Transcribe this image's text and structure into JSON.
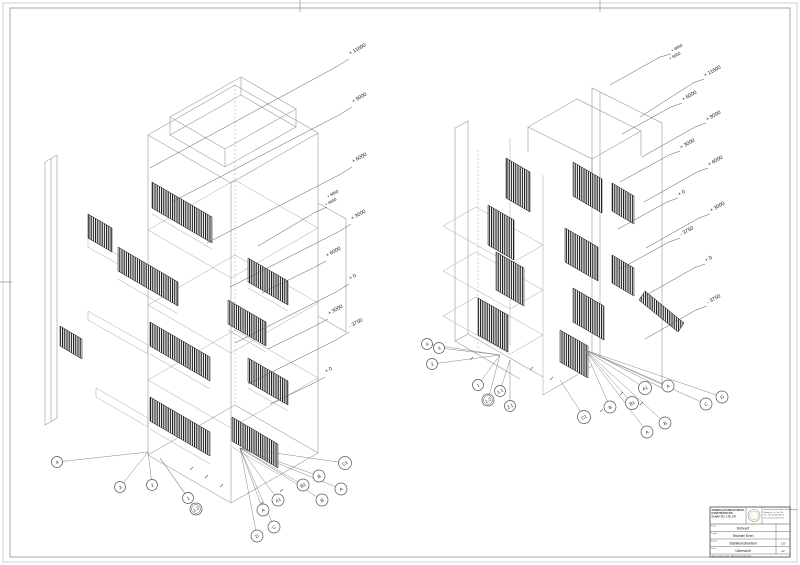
{
  "views": {
    "left": {
      "elevations": [
        "+ 11600",
        "+ 9000",
        "+ 6000",
        "+ 8850",
        "+ 8650",
        "+ 3000",
        "+ 6000",
        "+ 0",
        "+ 3000",
        "- 3750",
        "+ 0"
      ],
      "grid_letters": [
        "C1",
        "B",
        "A",
        "B1",
        "A1",
        "B",
        "A",
        "C",
        "D"
      ],
      "grid_numbers": [
        "4",
        "3",
        "2",
        "1",
        "1.2"
      ]
    },
    "right": {
      "elevations": [
        "+ 8850",
        "+ 8650",
        "+ 11600",
        "+ 6000",
        "+ 9000",
        "+ 3000",
        "+ 6000",
        "+ 0",
        "+ 3000",
        "- 3750",
        "+ 0",
        "- 3750"
      ],
      "grid_letters": [
        "A1",
        "A",
        "D",
        "B1",
        "C",
        "B",
        "B",
        "A",
        "C1"
      ],
      "grid_numbers": [
        "4",
        "3",
        "2",
        "1",
        "1.2",
        "1.1",
        "2.1"
      ]
    }
  },
  "title_block": {
    "company_lines": [
      "GENERALÜS İNŞAAT METAL",
      "KONSTRÜKSİYON",
      "SANAYİ TİC. LTD. ŞTİ."
    ],
    "contact_lines": [
      "Generalüs İnşaat Metal Konstrüksiyon",
      "Sanayi ve Tic. Ltd. Şti.",
      "Tel. +90 212 000 00 00",
      "Fax +90 212 000 00 01"
    ],
    "rows": [
      {
        "label": "Phase",
        "value": "Entwurf"
      },
      {
        "label": "Projekt",
        "value": "Tekinler Eren"
      },
      {
        "label": "Bauteil",
        "value": "Stahlkonstruktion"
      },
      {
        "label": "Inhalt",
        "value": "Übersicht"
      }
    ],
    "side_cells": [
      "",
      "",
      "1:50",
      "A2"
    ],
    "footer": "Maße am Bau prüfen · Alle Rechte vorbehalten"
  }
}
